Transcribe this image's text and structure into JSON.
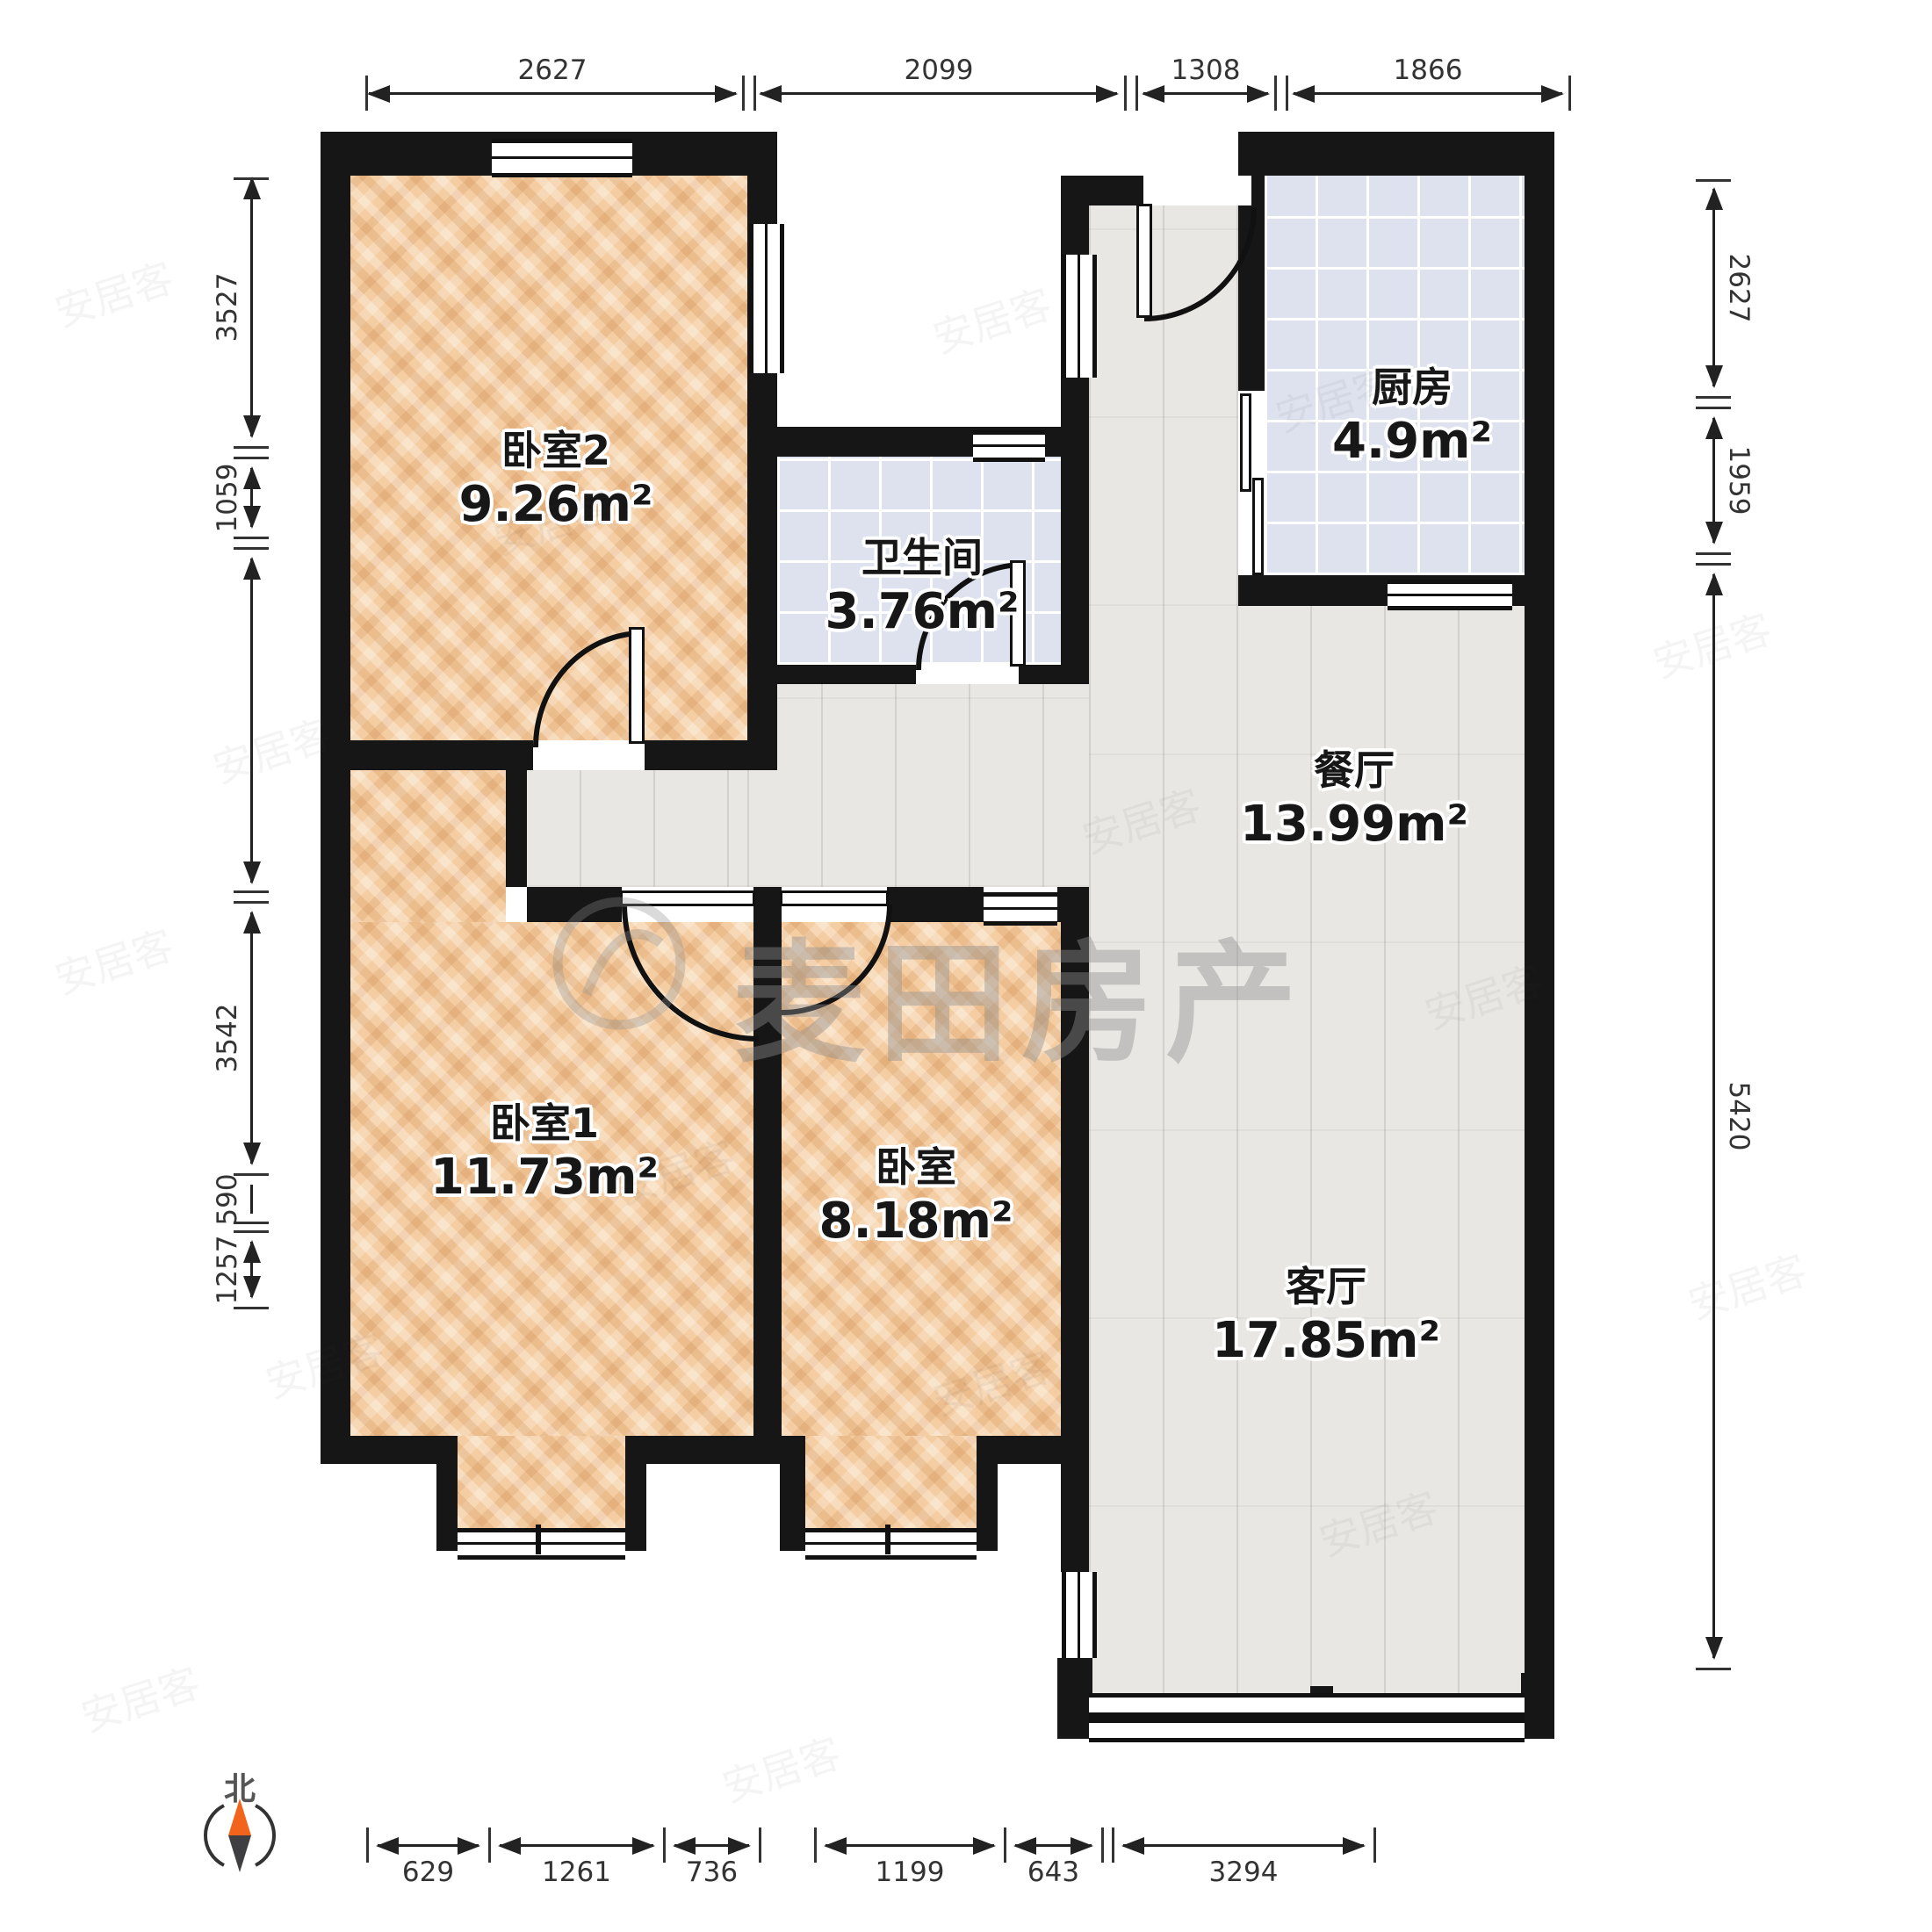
{
  "rooms": [
    {
      "id": "bedroom2",
      "name": "卧室2",
      "area": "9.26m²"
    },
    {
      "id": "bathroom",
      "name": "卫生间",
      "area": "3.76m²"
    },
    {
      "id": "kitchen",
      "name": "厨房",
      "area": "4.9m²"
    },
    {
      "id": "dining",
      "name": "餐厅",
      "area": "13.99m²"
    },
    {
      "id": "bedroom1",
      "name": "卧室1",
      "area": "11.73m²"
    },
    {
      "id": "bedroom",
      "name": "卧室",
      "area": "8.18m²"
    },
    {
      "id": "living",
      "name": "客厅",
      "area": "17.85m²"
    }
  ],
  "dimensions": {
    "top": [
      "2627",
      "2099",
      "1308",
      "1866"
    ],
    "bottom": [
      "629",
      "1261",
      "736",
      "1199",
      "643",
      "3294"
    ],
    "left": [
      "3527",
      "1059",
      "3542",
      "590",
      "1257"
    ],
    "right": [
      "2627",
      "1959",
      "5420"
    ]
  },
  "compass": {
    "label": "北"
  },
  "watermark": {
    "brand": "麦田房产",
    "portal": "安居客"
  },
  "colors": {
    "wall": "#161616",
    "wood": "#f5cda2",
    "tile": "#dde2ee",
    "plank": "#e9e7e4",
    "compass_orange": "#f2641c"
  }
}
